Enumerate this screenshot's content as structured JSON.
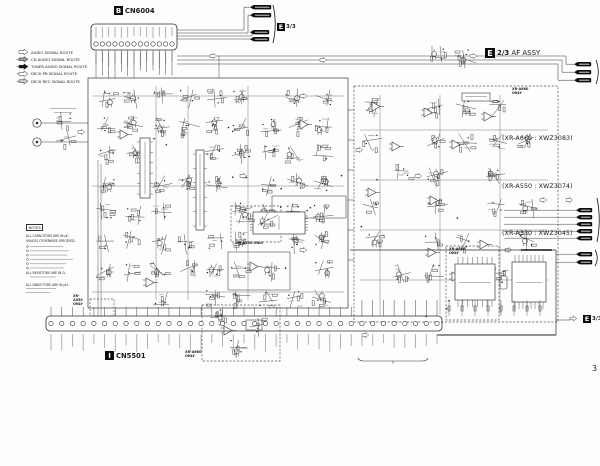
{
  "page": {
    "number": "3"
  },
  "title_block": {
    "badge": "E",
    "page_ref": "2/3",
    "assy": "AF ASSY",
    "models": [
      "(XR-A660 : XWZ3083)",
      "(XR-A550 : XWZ3074)",
      "(XR-A330 : XWZ3045)"
    ]
  },
  "connectors": {
    "top": {
      "badge": "B",
      "ref": "CN6004"
    },
    "bottom": {
      "badge": "I",
      "ref": "CN5501"
    }
  },
  "legend": {
    "items": [
      "AUDIO SIGNAL ROUTE",
      "CD AUDIO SIGNAL ROUTE",
      "TUNER AUDIO SIGNAL ROUTE",
      "DECK PB SIGNAL ROUTE",
      "DECK REC SIGNAL ROUTE"
    ]
  },
  "notes": {
    "title": "NOTES",
    "lines": [
      "ALL CAPACITORS ARE IN µF,",
      "UNLESS OTHERWISE SPECIFIED.",
      "ALL RESISTORS ARE IN Ω.",
      "ALL INDUCTORS ARE IN µH."
    ]
  },
  "variant_labels": {
    "a550": "XR-A550 ONLY",
    "a330": "XR-A330 ONLY",
    "a660_mid": "XR-A660 ONLY",
    "a660_right": "XR-A660 ONLY",
    "a660_br": "XR-A660 ONLY"
  },
  "flags": {
    "e33_badge": "E",
    "e33_ref": "3/3"
  }
}
